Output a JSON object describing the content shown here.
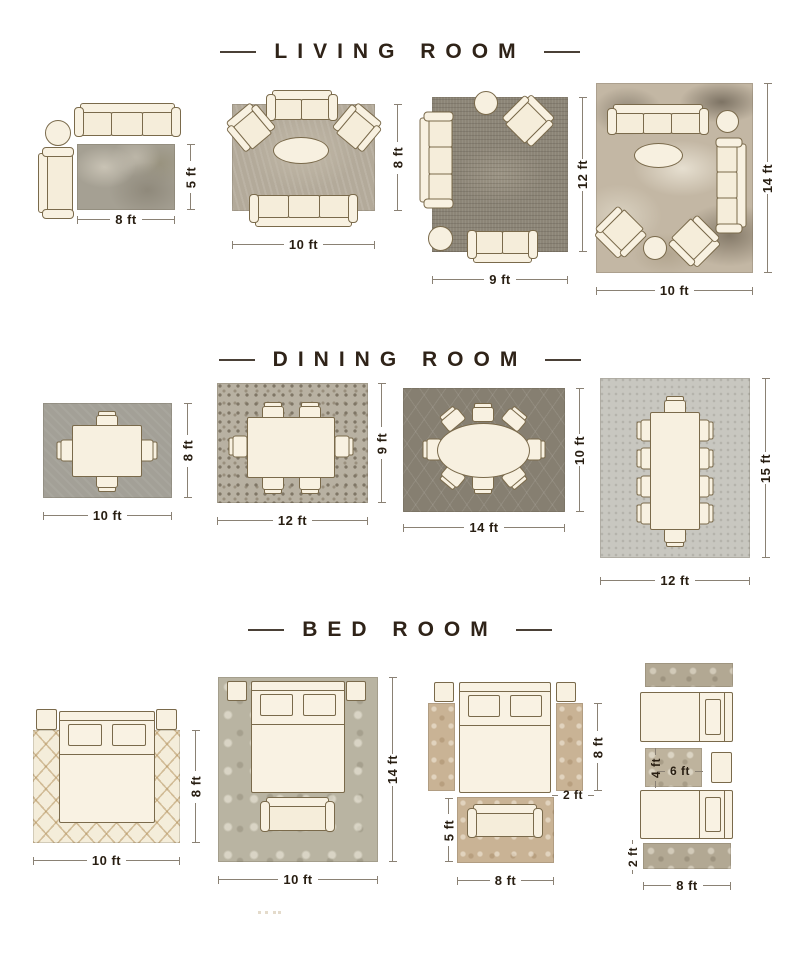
{
  "page": {
    "background": "#ffffff"
  },
  "colors": {
    "title_text": "#2f2318",
    "dimension_text": "#281e12",
    "dimension_line": "#8a8174",
    "furniture_fill": "#f8f1e1",
    "furniture_outline": "#7a6a4b"
  },
  "sections": [
    {
      "id": "living-room",
      "title": "LIVING ROOM",
      "layouts": [
        {
          "name": "sofa-chaise-side-table",
          "labels": {
            "width": "8 ft",
            "height": "5 ft"
          }
        },
        {
          "name": "sofa-two-armchairs-coffee-table",
          "labels": {
            "width": "10 ft",
            "height": "8 ft"
          }
        },
        {
          "name": "two-sofas-armchair-ottoman",
          "labels": {
            "width": "9 ft",
            "height": "12 ft"
          }
        },
        {
          "name": "two-sofas-two-armchairs",
          "labels": {
            "width": "10 ft",
            "height": "14 ft"
          }
        }
      ]
    },
    {
      "id": "dining-room",
      "title": "DINING ROOM",
      "layouts": [
        {
          "name": "table-four-chairs",
          "labels": {
            "width": "10 ft",
            "height": "8 ft"
          }
        },
        {
          "name": "table-six-chairs",
          "labels": {
            "width": "12 ft",
            "height": "9 ft"
          }
        },
        {
          "name": "oval-table-eight-chairs",
          "labels": {
            "width": "14 ft",
            "height": "10 ft"
          }
        },
        {
          "name": "table-ten-chairs",
          "labels": {
            "width": "12 ft",
            "height": "15 ft"
          }
        }
      ]
    },
    {
      "id": "bed-room",
      "title": "BED ROOM",
      "layouts": [
        {
          "name": "bed-partial-rug",
          "labels": {
            "width": "10 ft",
            "height": "8 ft"
          }
        },
        {
          "name": "bed-bench-full-rug",
          "labels": {
            "width": "10 ft",
            "height": "14 ft"
          }
        },
        {
          "name": "bed-side-runners-foot-rug",
          "labels": {
            "runner_height": "8 ft",
            "runner_width": "2 ft",
            "foot_rug_height": "5 ft",
            "foot_rug_width": "8 ft"
          }
        },
        {
          "name": "twin-beds-runners-center-rug",
          "labels": {
            "mid_rug_height": "4 ft",
            "mid_rug_width": "6 ft",
            "runner_height": "2 ft",
            "runner_width": "8 ft"
          }
        }
      ]
    }
  ]
}
